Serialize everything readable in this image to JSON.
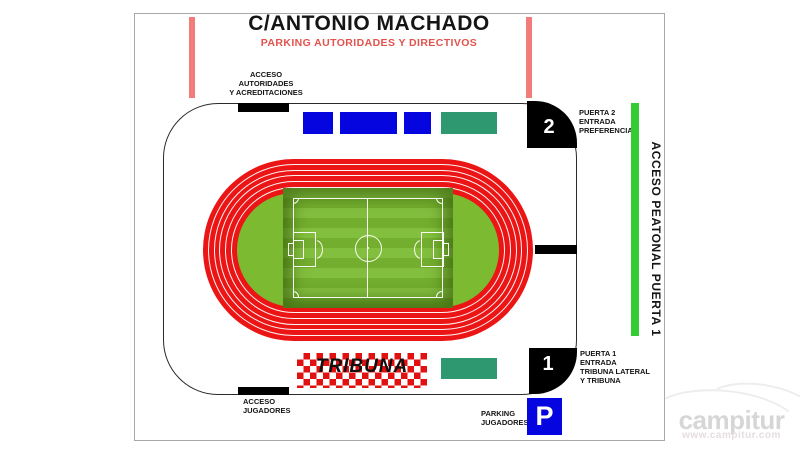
{
  "header": {
    "street": "C/ANTONIO MACHADO",
    "parking_note": "PARKING AUTORIDADES Y DIRECTIVOS"
  },
  "stadium": {
    "tribuna_label": "TRIBUNA",
    "gates": {
      "gate2": {
        "number": "2",
        "line1": "PUERTA 2",
        "line2": "ENTRADA",
        "line3": "PREFERENCIA"
      },
      "gate1": {
        "number": "1",
        "line1": "PUERTA 1",
        "line2": "ENTRADA",
        "line3": "TRIBUNA LATERAL",
        "line4": "Y TRIBUNA"
      }
    },
    "accesses": {
      "authorities_line1": "ACCESO",
      "authorities_line2": "AUTORIDADES",
      "authorities_line3": "Y ACREDITACIONES",
      "players_line1": "ACCESO",
      "players_line2": "JUGADORES",
      "pedestrian": "ACCESO PEATONAL PUERTA 1"
    },
    "parking": {
      "players_line1": "PARKING",
      "players_line2": "JUGADORES",
      "symbol": "P"
    }
  },
  "watermark": {
    "brand": "campitur",
    "site": "www.campitur.com"
  },
  "colors": {
    "track_red": "#EC1515",
    "infield_green": "#7CBA31",
    "seat_blue": "#0505E0",
    "seat_green": "#2E9970",
    "salmon_bar": "#F17C7A",
    "pedestrian_green": "#33CC33",
    "subtitle_red": "#E2534E",
    "checker_red": "#E21111",
    "parking_blue": "#0505E0"
  }
}
